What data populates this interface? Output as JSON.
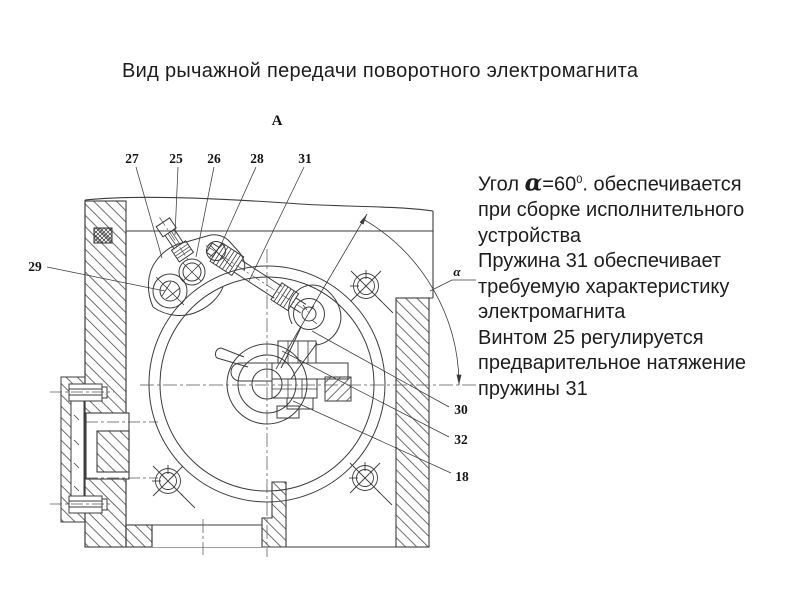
{
  "title": "Вид рычажной передачи поворотного электромагнита",
  "view_label": "А",
  "angle_label": "α",
  "part_labels": {
    "p27": "27",
    "p25": "25",
    "p26": "26",
    "p28": "28",
    "p31": "31",
    "p29": "29",
    "p30": "30",
    "p32": "32",
    "p18": "18"
  },
  "notes": {
    "line1": {
      "prefix": "Угол ",
      "alpha": "α",
      "value": "=60",
      "sup": "0",
      "suffix": ". обеспечивается"
    },
    "lines": [
      "при сборке исполнительного",
      "устройства",
      "Пружина 31 обеспечивает",
      "требуемую характеристику",
      "электромагнита",
      "Винтом 25 регулируется",
      "предварительное натяжение",
      "пружины 31"
    ]
  }
}
